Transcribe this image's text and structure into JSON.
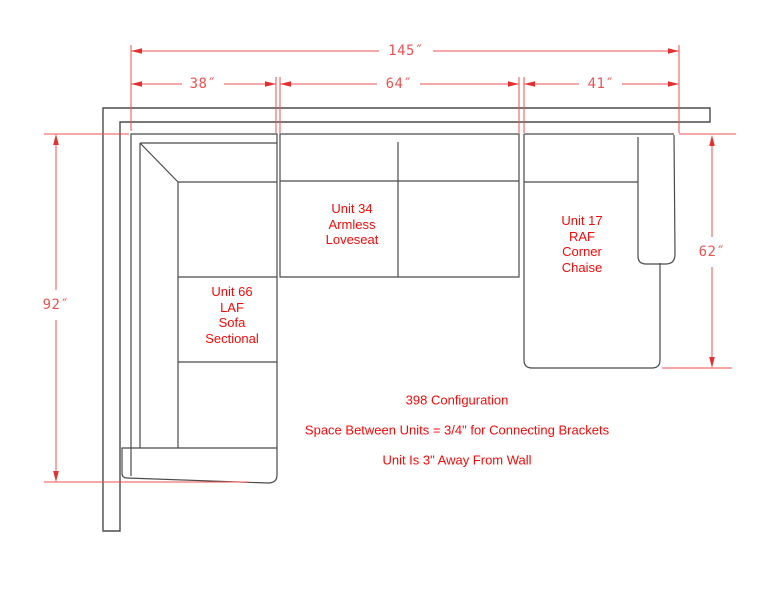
{
  "drawing": {
    "dimensions": {
      "total_width": "145″",
      "unit_66_width": "38″",
      "unit_34_width": "64″",
      "unit_17_width": "41″",
      "left_depth": "92″",
      "right_depth": "62″"
    },
    "units": [
      {
        "name": "unit-66",
        "label": "Unit 66\nLAF\nSofa\nSectional"
      },
      {
        "name": "unit-34",
        "label": "Unit 34\nArmless\nLoveseat"
      },
      {
        "name": "unit-17",
        "label": "Unit 17\nRAF\nCorner\nChaise"
      }
    ],
    "notes": {
      "line1": "398 Configuration",
      "line2": "Space Between Units = 3/4\" for Connecting Brackets",
      "line3": "Unit Is 3\" Away From Wall"
    },
    "colors": {
      "dimension_red": "#e85454",
      "arrow_red": "#e23030",
      "label_red": "#f40a0a",
      "furniture_gray": "#4b4b4b",
      "background": "#ffffff"
    }
  }
}
